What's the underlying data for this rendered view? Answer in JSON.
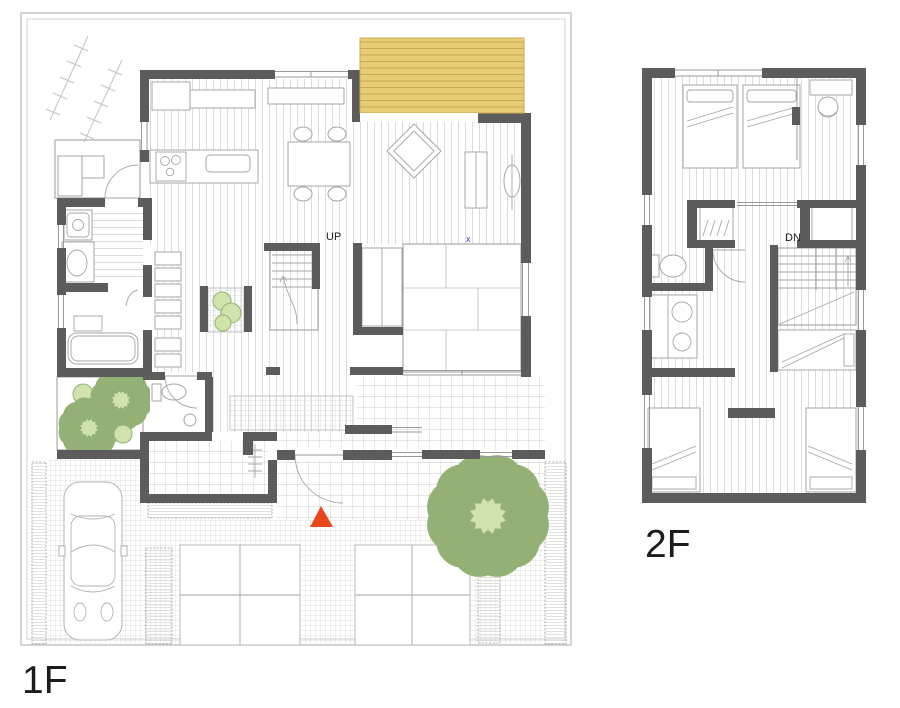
{
  "plans": {
    "first_floor": {
      "label": "1F",
      "stair_label": "UP",
      "floor_marker": "x"
    },
    "second_floor": {
      "label": "2F",
      "stair_label": "DN"
    }
  },
  "symbols": {
    "entrance_marker": "entrance-triangle-icon"
  },
  "colors": {
    "wall": "#5c5c5c",
    "deck": "#e7cd74",
    "deckline": "#c8a959",
    "tree": "#cfe3aa",
    "treeline": "#93b175",
    "accent": "#e8481c",
    "blue": "#3d3dc4",
    "ink": "#1c1c1c",
    "line": "#9a9a9a",
    "grid": "#c6c6c6",
    "plank": "#d4d4d4"
  }
}
